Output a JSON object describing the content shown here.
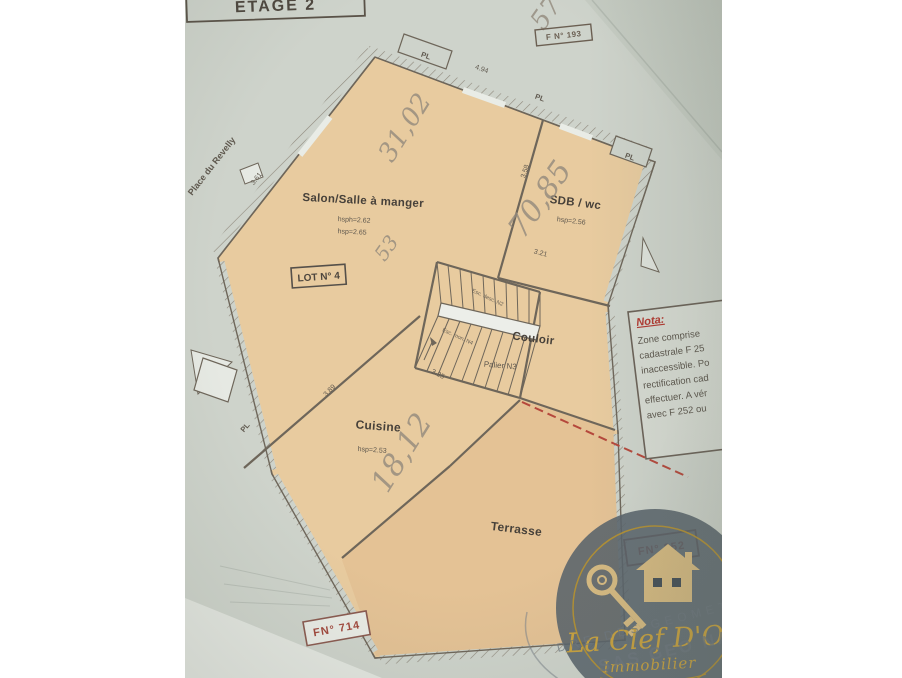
{
  "stamps": {
    "etage": "ETAGE 2",
    "fn_top": "F N° 193",
    "fn_bottom": "FN° 714",
    "fn_right": "FN° 252"
  },
  "street": "Place du Revelly",
  "lot_label": "LOT N° 4",
  "rooms": {
    "salon": {
      "name": "Salon/Salle à manger",
      "height1": "hsph=2.62",
      "height2": "hsp=2.65",
      "handwritten": "31,02"
    },
    "sdb": {
      "name": "SDB / wc",
      "height": "hsp=2.56",
      "handwritten": "70,85"
    },
    "couloir": {
      "name": "Couloir"
    },
    "palier": {
      "name": "Palier N3"
    },
    "cuisine": {
      "name": "Cuisine",
      "height": "hsp=2.53",
      "handwritten": "18,12"
    },
    "terrasse": {
      "name": "Terrasse"
    }
  },
  "stairs": {
    "flight_up": "Esc. desc. N2",
    "flight_down": "Esc. mon. N4"
  },
  "measurements": {
    "top_wall": "4.94",
    "left_wall": "3.61",
    "sdb_wall": "3.58",
    "couloir_wall": "3.21",
    "stairs_wall": "3.25",
    "cuisine_wall": "3.89",
    "closet": "PL"
  },
  "handwritten_extra": {
    "top_right": "57",
    "salon_side": "53"
  },
  "nota": {
    "title": "Nota:",
    "lines": [
      "Zone comprise",
      "cadastrale F 25",
      "inaccessible. Po",
      "rectification cad",
      "effectuer. A vér",
      "avec F 252 ou"
    ]
  },
  "logo": {
    "title": "La Clef D'Or",
    "subtitle": "Immobilier"
  },
  "watermark": {
    "arc_text": "DRE DES GEOMETR",
    "company": "SAS GEO NA"
  },
  "colors": {
    "paper": "#ced3cb",
    "room_fill": "#e8cb9f",
    "terrace_fill": "#e3c193",
    "wall": "#6e665a",
    "stamp_red": "#a1483d",
    "nota_red": "#b23830",
    "logo_gold": "#c9a23f",
    "logo_bg": "#59636b",
    "pencil": "#938a7d",
    "red_dash": "#b5483c"
  }
}
